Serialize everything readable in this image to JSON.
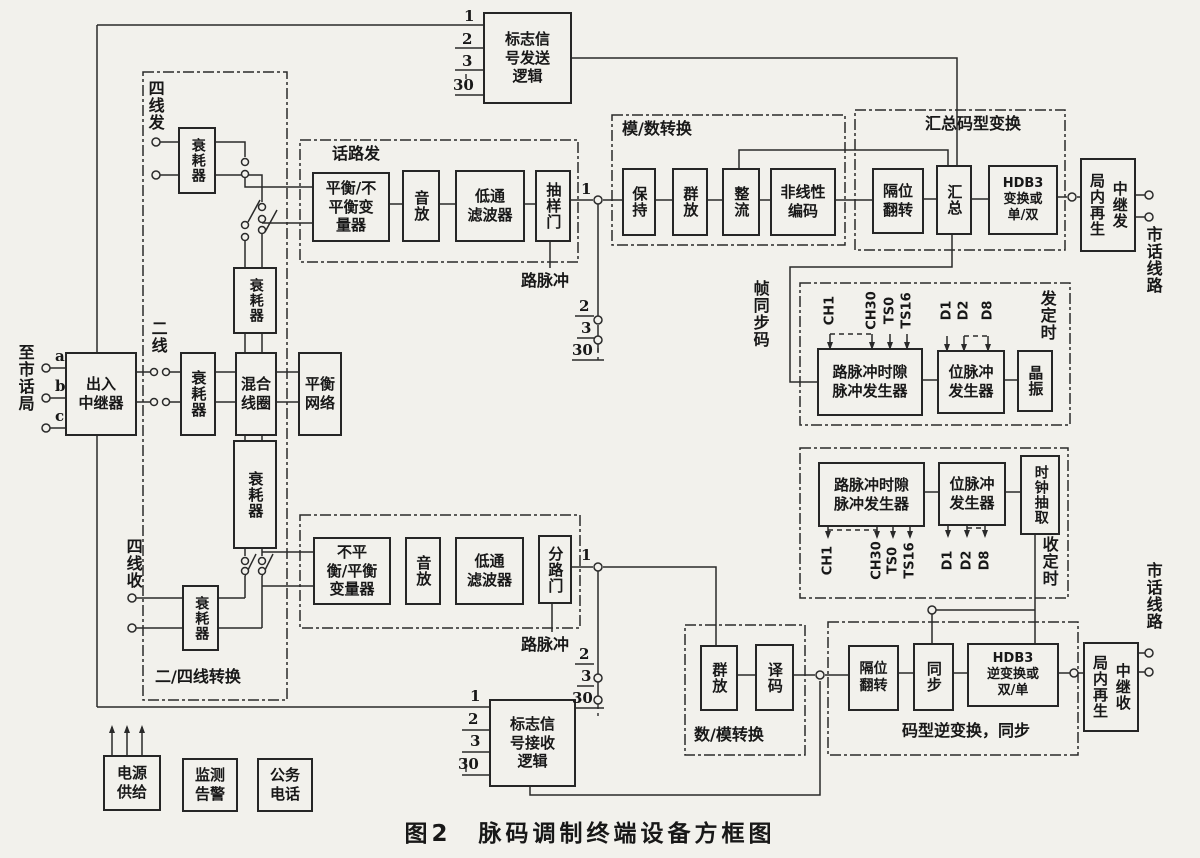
{
  "caption": "图2　脉码调制终端设备方框图",
  "boxes": {
    "flag_send": "标志信\n号发送\n逻辑",
    "flag_recv": "标志信\n号接收\n逻辑",
    "repeater": "出入\n中继器",
    "attenuator": "衰耗器",
    "hybrid": "混合\n线圈",
    "balance": "平衡\n网络",
    "bal_unbal": "平衡/不\n平衡变\n量器",
    "unbal_bal": "不平\n衡/平衡\n变量器",
    "amp": "音放",
    "lpf": "低通\n滤波器",
    "sample_gate": "抽样门",
    "branch_gate": "分路门",
    "hold": "保持",
    "group_amp": "群放",
    "rectifier": "整流",
    "nonlinear": "非线性\n编码",
    "bit_flip": "隔位\n翻转",
    "sum": "汇总",
    "hdb3_tx": "HDB3\n变换或\n单/双",
    "hdb3_rx": "HDB3\n逆变换或\n双/单",
    "regen": "局内再生",
    "relay_tx": "中继发",
    "relay_rx": "中继收",
    "ch_ts_gen": "路脉冲时隙\n脉冲发生器",
    "bit_gen": "位脉冲\n发生器",
    "crystal": "晶振",
    "clock_ext": "时钟抽取",
    "decode": "译码",
    "sync": "同步",
    "power": "电源\n供给",
    "monitor": "监测\n告警",
    "service": "公务\n电话"
  },
  "sections": {
    "voice_tx": "话路发",
    "ad": "模/数转换",
    "sum_code": "汇总码型变换",
    "tx_timing": "发定时",
    "rx_timing": "收定时",
    "da": "数/模转换",
    "code_inv": "码型逆变换，同步",
    "two_four": "二/四线转换"
  },
  "side_labels": {
    "to_city": "至市话局",
    "four_tx": "四线发",
    "four_rx": "四线收",
    "two_wire": "二线",
    "frame_sync": "帧同步码",
    "city_line": "市话线路",
    "ch_pulse": "路脉冲"
  },
  "pins": {
    "n1": "1",
    "n2": "2",
    "n3": "3",
    "n30": "30",
    "a": "a",
    "b": "b",
    "c": "c"
  },
  "timing_labels": {
    "ch1": "CH1",
    "ch30": "CH30",
    "ts0": "TS0",
    "ts16": "TS16",
    "d1": "D1",
    "d2": "D2",
    "d8": "D8"
  }
}
